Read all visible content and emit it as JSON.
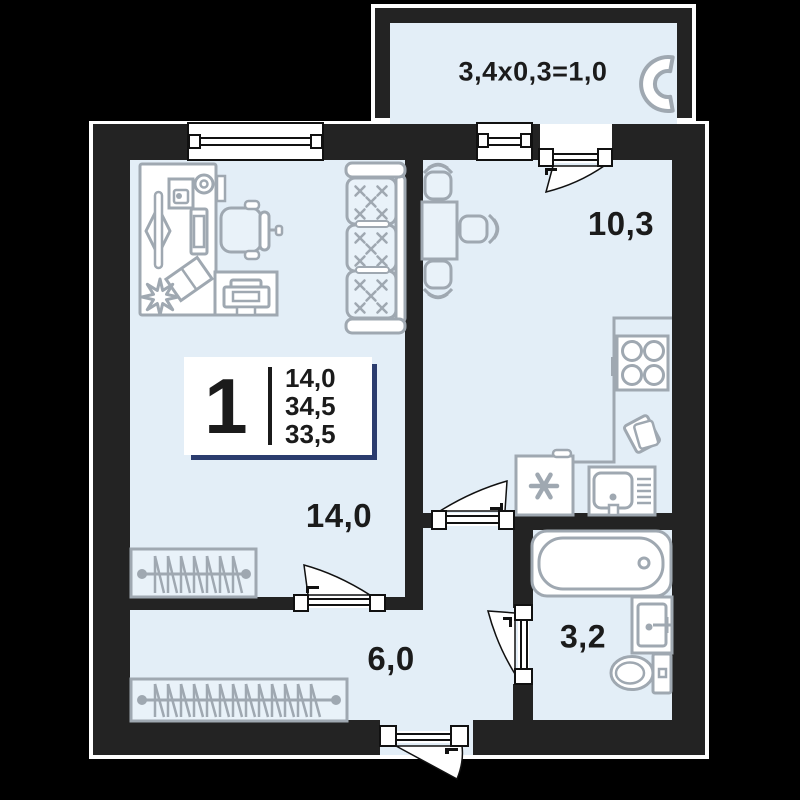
{
  "colors": {
    "background": "#000000",
    "walls": "#232323",
    "room_fill": "#e3eef7",
    "furniture": "#9fa8b1",
    "text": "#1b1b1b",
    "card_shadow": "#2b3c6e",
    "door_stroke": "#111111"
  },
  "labels": {
    "balcony_dim": "3,4x0,3=1,0",
    "kitchen_area": "10,3",
    "living_area": "14,0",
    "hall_area": "6,0",
    "bath_area": "3,2"
  },
  "info_card": {
    "rooms_count": "1",
    "area_lines": [
      "14,0",
      "34,5",
      "33,5"
    ]
  }
}
